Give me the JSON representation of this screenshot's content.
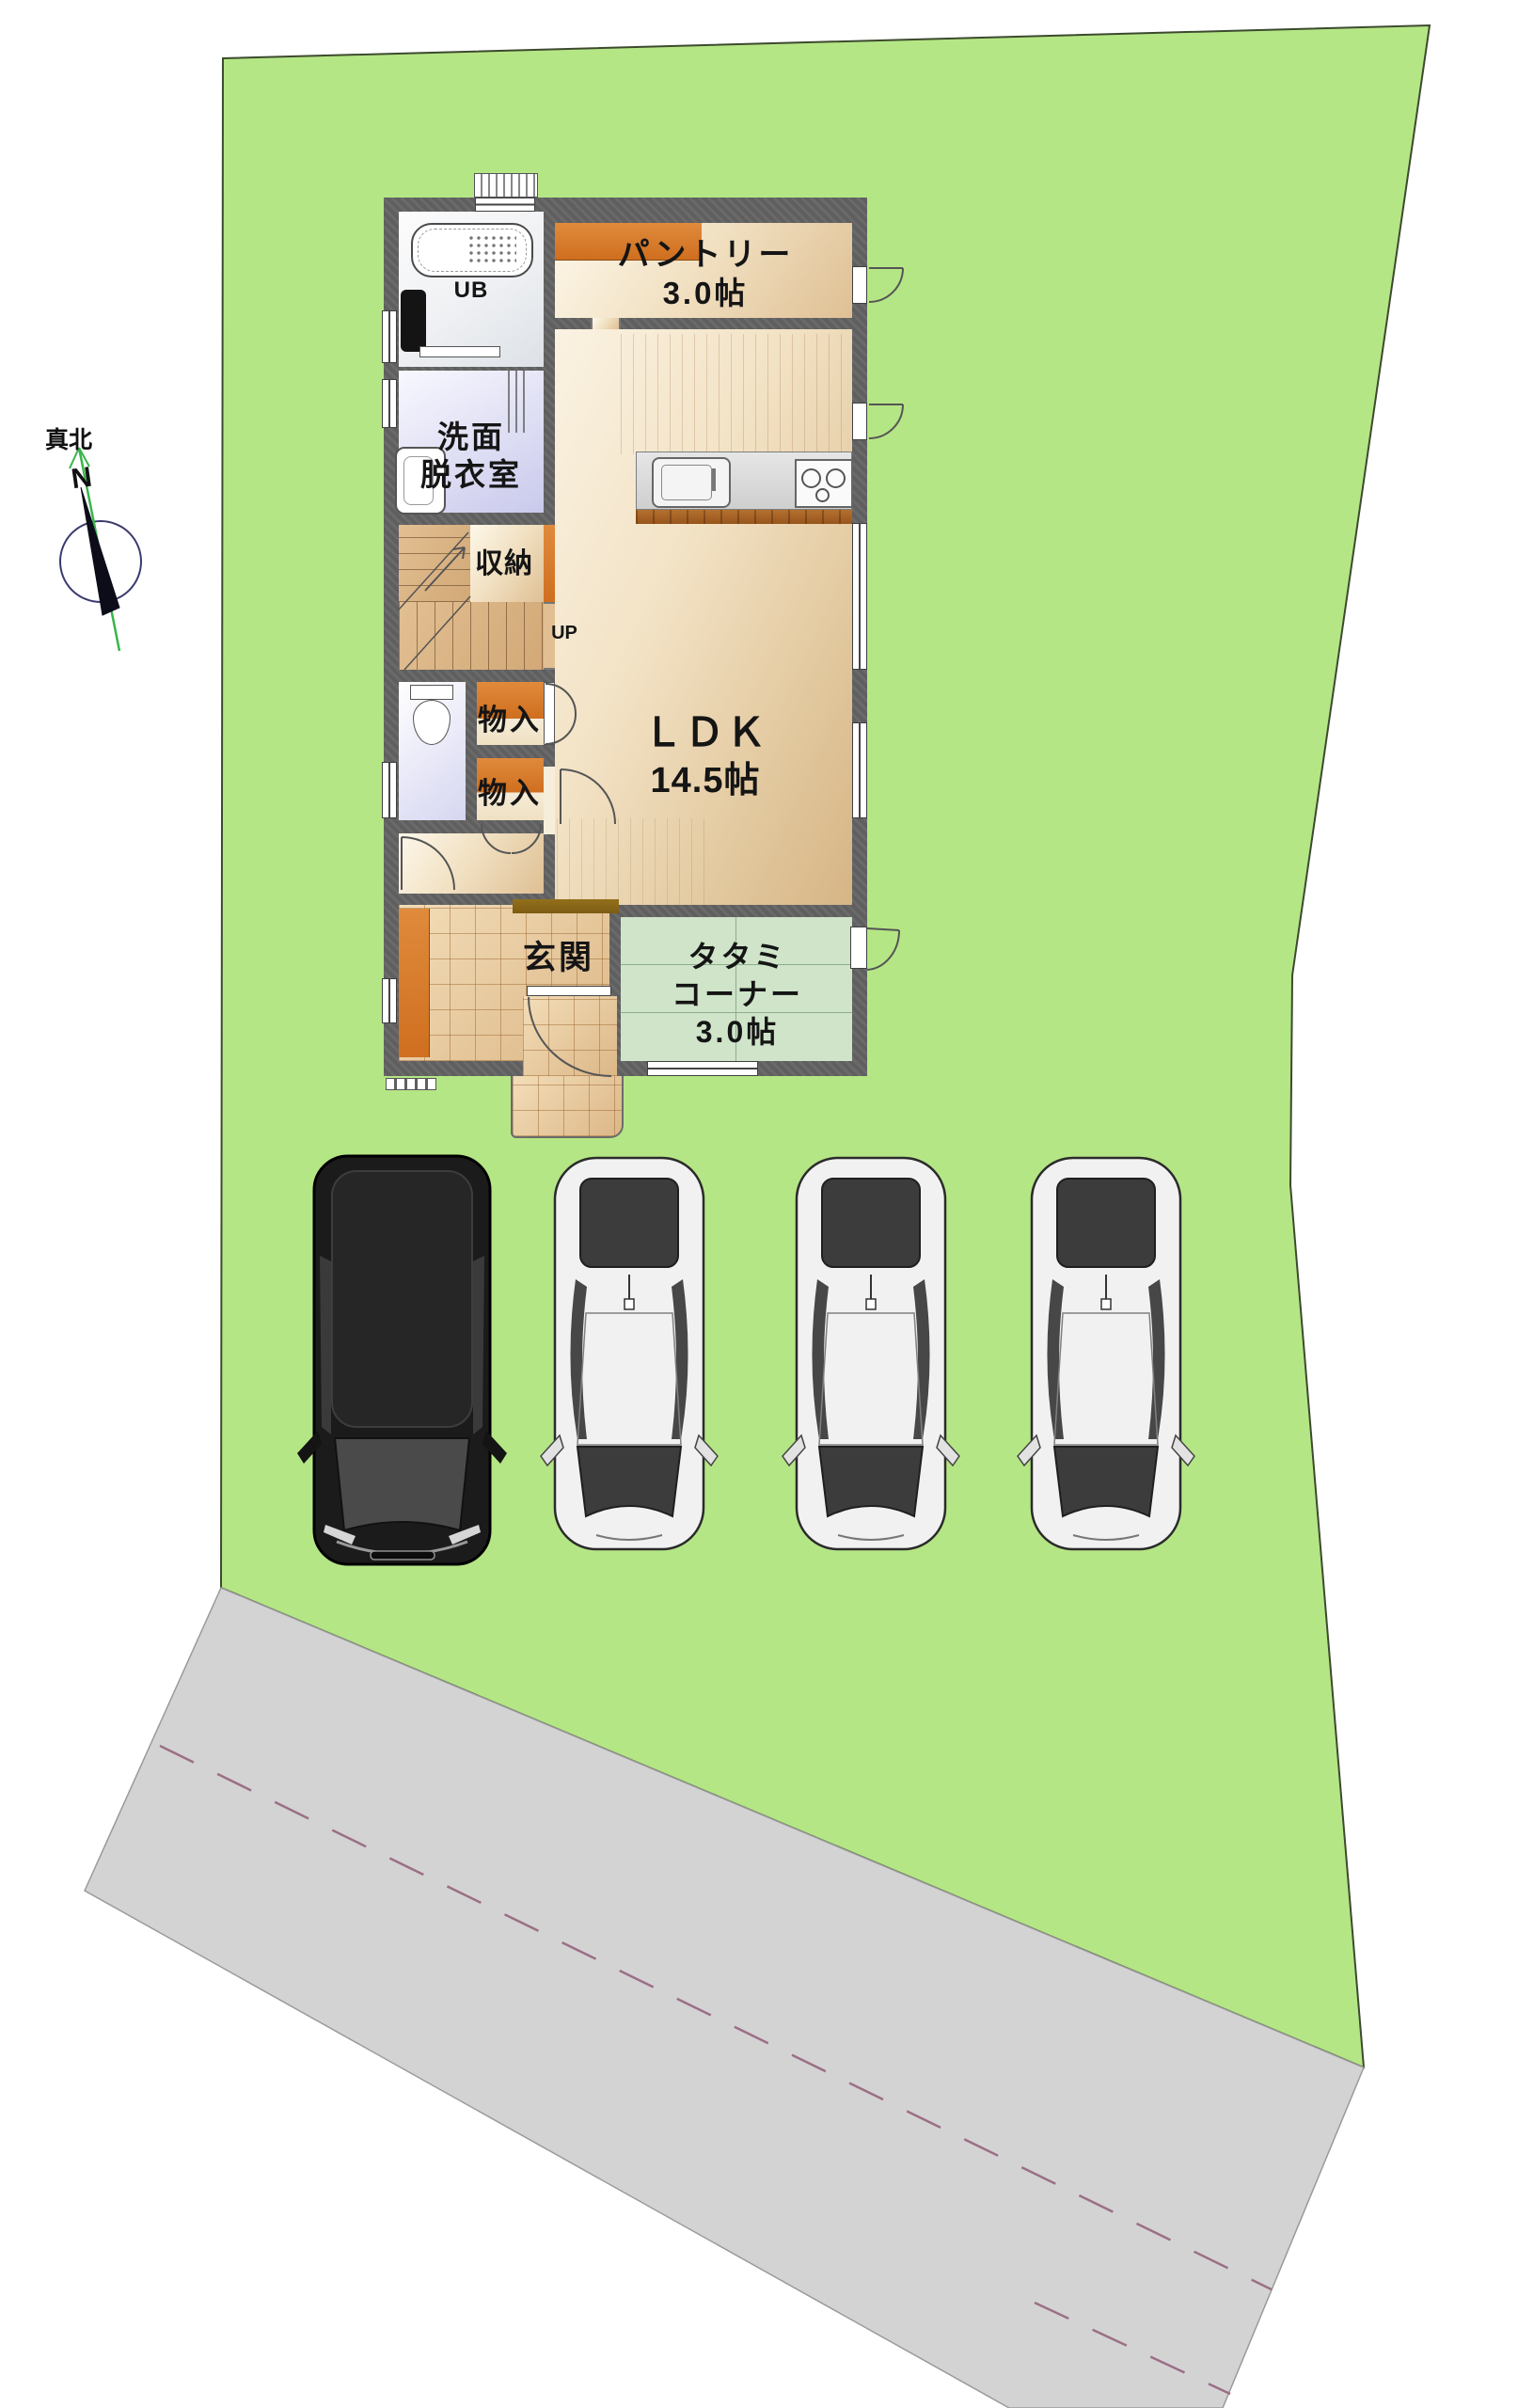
{
  "site": {
    "compass": {
      "true_north_label": "真北",
      "north_letter": "N"
    },
    "lot_color": "#b5e685",
    "road_color": "#d3d3d3",
    "road_dash_color": "#9b6f86"
  },
  "floor_plan": {
    "wall_color": "#5f5f5f",
    "rooms": {
      "ub": {
        "label": "UB"
      },
      "pantry": {
        "name": "パントリー",
        "size": "3.0帖"
      },
      "washroom": {
        "line1": "洗面",
        "line2": "脱衣室"
      },
      "storage": {
        "label": "収納"
      },
      "ldk": {
        "name": "ＬＤＫ",
        "size": "14.5帖"
      },
      "closet_upper": {
        "label": "物入"
      },
      "closet_lower": {
        "label": "物入"
      },
      "entrance": {
        "label": "玄関"
      },
      "tatami": {
        "line1": "タタミ",
        "line2": "コーナー",
        "line3": "3.0帖"
      },
      "stairs": {
        "up_label": "UP"
      }
    }
  },
  "vehicles": [
    {
      "type": "minivan",
      "body_color": "#1b1b1b"
    },
    {
      "type": "sedan",
      "body_color": "#f1f1f1"
    },
    {
      "type": "sedan",
      "body_color": "#f1f1f1"
    },
    {
      "type": "sedan",
      "body_color": "#f1f1f1"
    }
  ]
}
